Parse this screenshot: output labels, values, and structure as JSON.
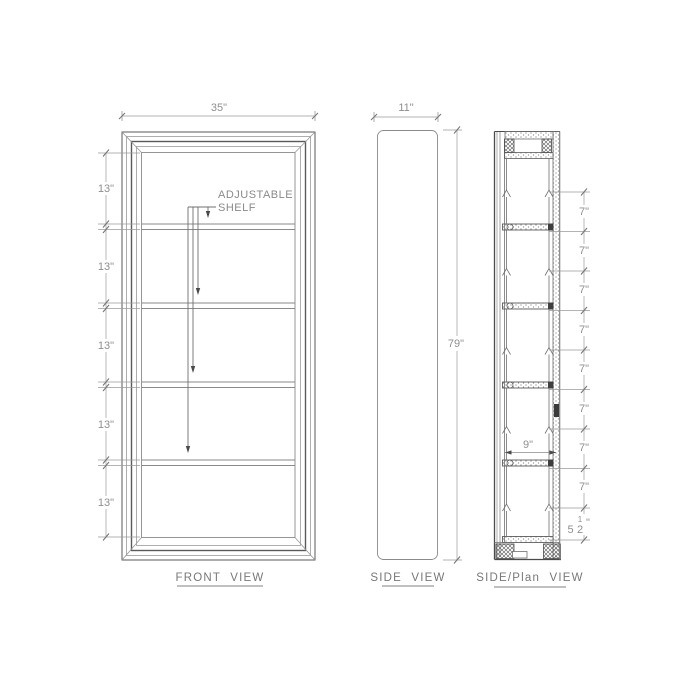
{
  "drawing": {
    "front_view": {
      "title": "FRONT VIEW",
      "width_dim": "35\"",
      "shelf_spacing_dims": [
        "13\"",
        "13\"",
        "13\"",
        "13\"",
        "13\""
      ],
      "annotation": {
        "line1": "ADJUSTABLE",
        "line2": "SHELF"
      }
    },
    "side_view": {
      "title": "SIDE VIEW",
      "width_dim": "11\"",
      "height_dim": "79\""
    },
    "side_plan_view": {
      "title": "SIDE/Plan VIEW",
      "depth_dim": "9\"",
      "pin_spacing_dims": [
        "7\"",
        "7\"",
        "7\"",
        "7\"",
        "7\"",
        "7\"",
        "7\"",
        "7\""
      ],
      "bottom_dim": {
        "whole": "5",
        "num": "1",
        "den": "2",
        "unit": "\""
      }
    },
    "colors": {
      "background": "#ffffff",
      "object_line": "#6f6f6f",
      "dark_line": "#4a4a4a",
      "dim_line": "#9a9a9a",
      "text": "#8f8f8f"
    }
  }
}
